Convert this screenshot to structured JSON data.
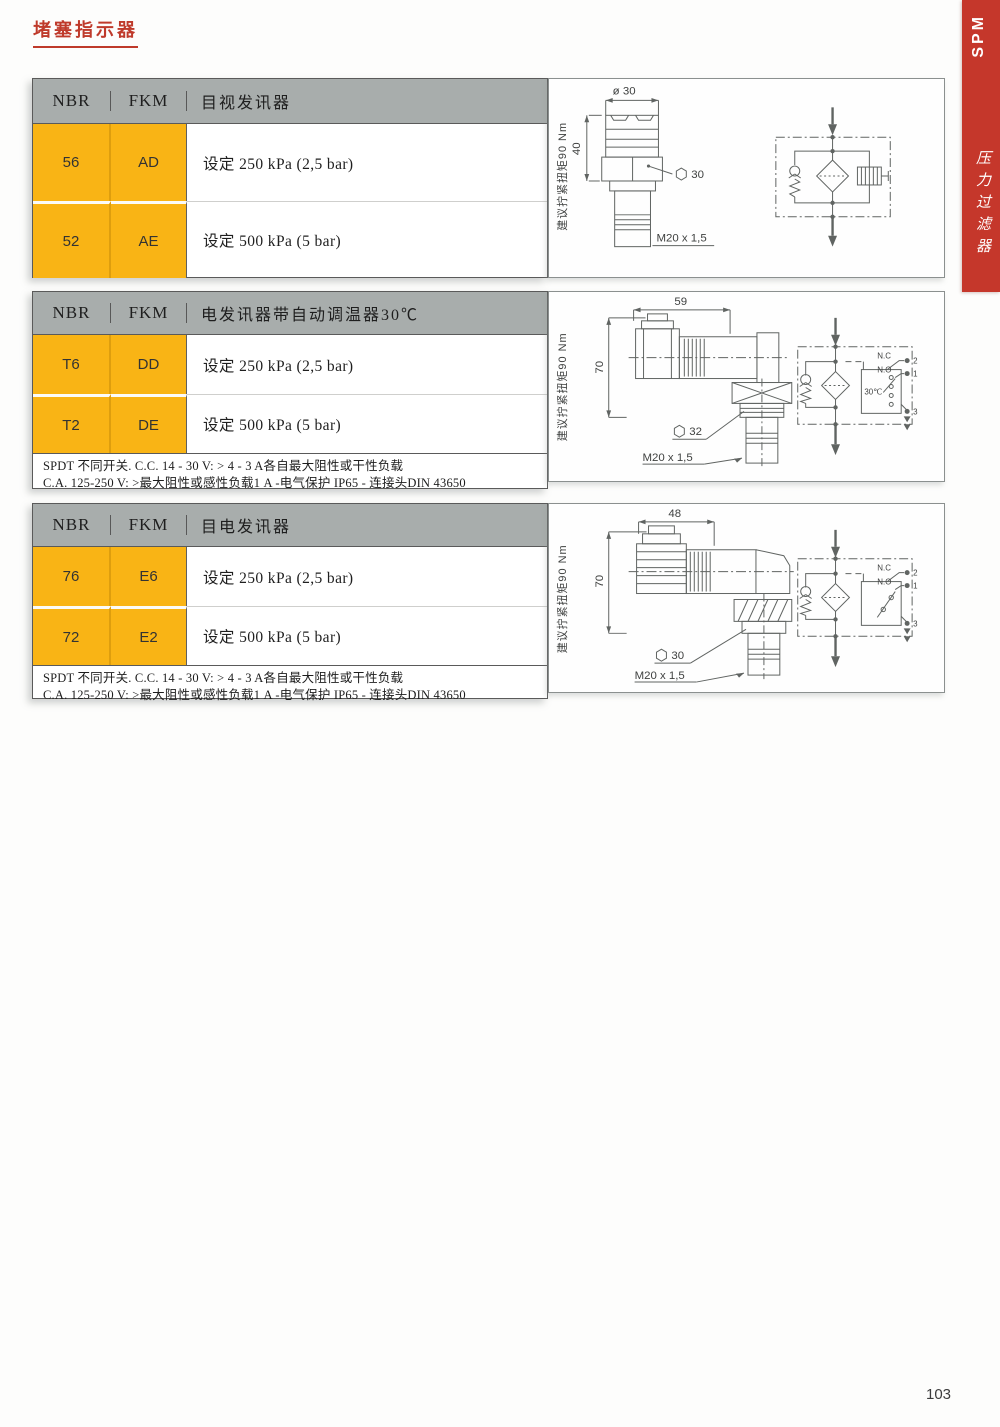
{
  "page": {
    "title": "堵塞指示器",
    "number": "103"
  },
  "side_tab": {
    "code": "SPM",
    "label": "压力过滤器"
  },
  "colors": {
    "accent_red": "#c5372b",
    "row_yellow": "#f9b415",
    "header_gray": "#a8adac"
  },
  "sections": [
    {
      "table": {
        "headers": [
          "NBR",
          "FKM",
          "目视发讯器"
        ],
        "rows": [
          {
            "nbr": "56",
            "fkm": "AD",
            "desc": "设定 250 kPa (2,5 bar)"
          },
          {
            "nbr": "52",
            "fkm": "AE",
            "desc": "设定 500 kPa (5 bar)"
          }
        ]
      },
      "drawing": {
        "torque": "建议拧紧扭矩90 Nm",
        "dim_top": "ø 30",
        "dim_side": "40",
        "hex_size": "30",
        "thread": "M20 x 1,5"
      }
    },
    {
      "table": {
        "headers": [
          "NBR",
          "FKM",
          "电发讯器带自动调温器30℃"
        ],
        "rows": [
          {
            "nbr": "T6",
            "fkm": "DD",
            "desc": "设定 250 kPa (2,5 bar)"
          },
          {
            "nbr": "T2",
            "fkm": "DE",
            "desc": "设定 500 kPa (5 bar)"
          }
        ],
        "note_line1": "SPDT 不同开关. C.C. 14 - 30 V: > 4 - 3 A各自最大阻性或干性负载",
        "note_line2": "C.A. 125-250 V: >最大阻性或感性负载1 A -电气保护 IP65 - 连接头DIN 43650"
      },
      "drawing": {
        "torque": "建议拧紧扭矩90 Nm",
        "dim_top": "59",
        "dim_side": "70",
        "hex_size": "32",
        "thread": "M20 x 1,5",
        "thermostat": "30℃",
        "nc": "N.C",
        "no": "N.O",
        "t1": "1",
        "t2": "2",
        "t3": "3"
      }
    },
    {
      "table": {
        "headers": [
          "NBR",
          "FKM",
          "目电发讯器"
        ],
        "rows": [
          {
            "nbr": "76",
            "fkm": "E6",
            "desc": "设定 250 kPa (2,5 bar)"
          },
          {
            "nbr": "72",
            "fkm": "E2",
            "desc": "设定 500 kPa (5 bar)"
          }
        ],
        "note_line1": "SPDT 不同开关. C.C. 14 - 30 V: > 4 - 3 A各自最大阻性或干性负载",
        "note_line2": "C.A. 125-250 V: >最大阻性或感性负载1 A -电气保护 IP65 - 连接头DIN 43650"
      },
      "drawing": {
        "torque": "建议拧紧扭矩90 Nm",
        "dim_top": "48",
        "dim_side": "70",
        "hex_size": "30",
        "thread": "M20 x 1,5",
        "nc": "N.C",
        "no": "N.O",
        "t1": "1",
        "t2": "2",
        "t3": "3"
      }
    }
  ]
}
